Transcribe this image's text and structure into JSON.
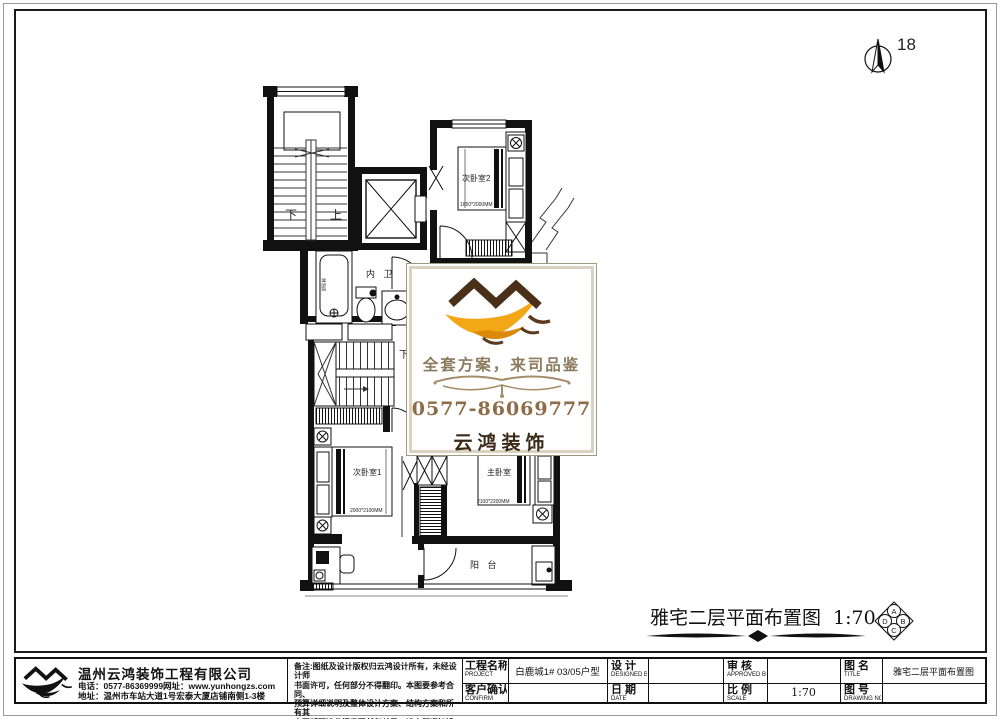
{
  "page": {
    "sheet_number": "18"
  },
  "plan": {
    "labels": {
      "stair_down": "下",
      "stair_up": "上",
      "bath": "内 卫",
      "tub": "淋浴房",
      "hall_down": "下",
      "bedroom2": "次卧室2",
      "bedroom1": "次卧室1",
      "master": "主卧室",
      "balcony": "阳 台"
    },
    "beds": {
      "bedroom2_dim": "1650*2000MM",
      "bedroom1_dim": "2000*2100MM",
      "master_dim": "2100*2200MM"
    },
    "title": {
      "text": "雅宅二层平面布置图",
      "scale": "1:70"
    },
    "orientation": {
      "top": "A",
      "right": "B",
      "bottom": "C",
      "left": "D"
    }
  },
  "watermark": {
    "slogan": "全套方案，来司品鉴",
    "phone": "0577-86069777",
    "brand": "云鸿装饰",
    "accent_orange": "#f2a716",
    "accent_brown": "#4a3018"
  },
  "titleblock": {
    "company": {
      "name": "温州云鸿装饰工程有限公司",
      "phone_line": "电话：0577-86369999网址：www.yunhongzs.com",
      "address_line": "地址：温州市车站大道1号宏泰大厦店铺南侧1-3楼"
    },
    "notes": [
      "备注:图纸及设计版权归云鸿设计所有，未经设计师",
      "书面许可，任何部分不得翻印。本图要参考合同、",
      "预算详细说明及整体设计方案、结构方案和所有其",
      "它图纸研读此间发现任何差异，请立即通知设计师。"
    ],
    "fields": {
      "project": {
        "label": "工程名称",
        "sub": "PROJECT",
        "value": "白鹿城1# 03/05户型"
      },
      "designed": {
        "label": "设 计",
        "sub": "DESIGNED BY",
        "value": ""
      },
      "approved": {
        "label": "审 核",
        "sub": "APPROVED BY",
        "value": ""
      },
      "drawing_title": {
        "label": "图 名",
        "sub": "TITLE",
        "value": "雅宅二层平面布置图"
      },
      "confirm": {
        "label": "客户确认",
        "sub": "CONFIRM",
        "value": ""
      },
      "date": {
        "label": "日 期",
        "sub": "DATE",
        "value": ""
      },
      "scale": {
        "label": "比 例",
        "sub": "SCALE",
        "value": "1:70"
      },
      "drawing_no": {
        "label": "图 号",
        "sub": "DRAWING NO",
        "value": ""
      }
    }
  }
}
